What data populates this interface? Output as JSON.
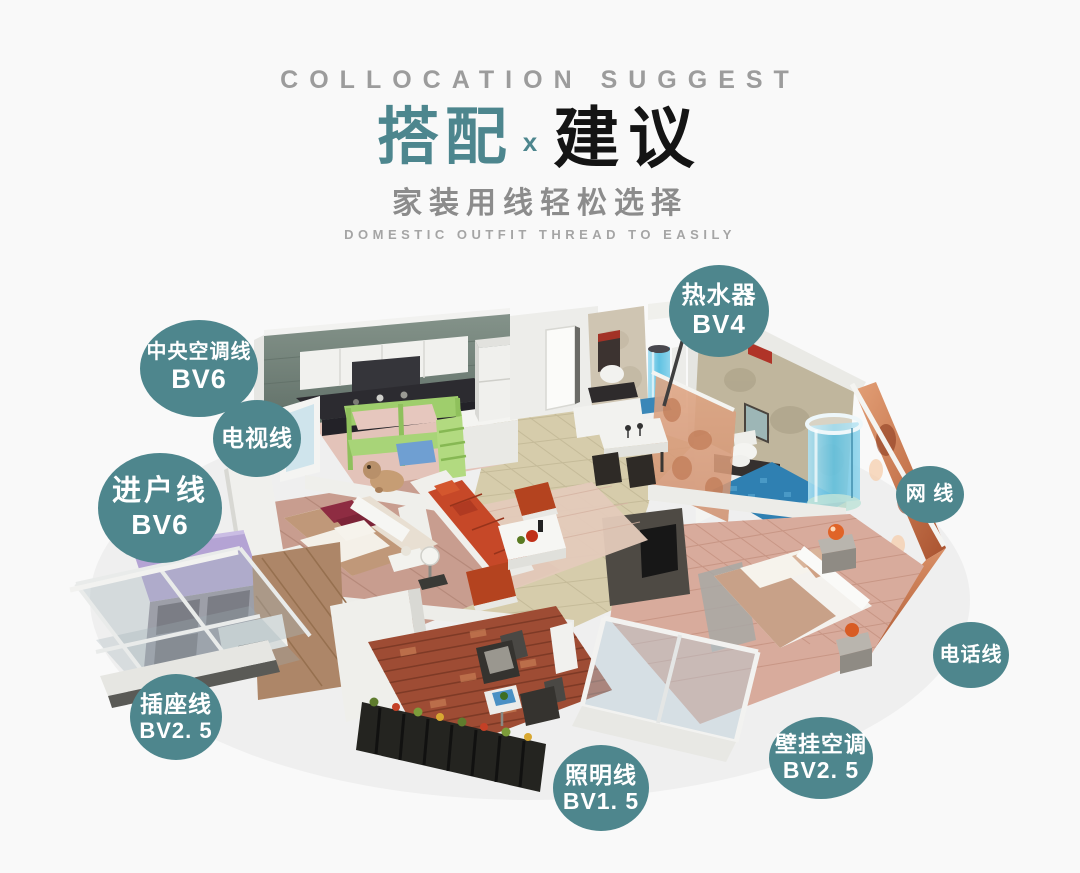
{
  "header": {
    "eyebrow": "COLLOCATION SUGGEST",
    "title_left": "搭配",
    "title_x": "x",
    "title_right": "建议",
    "subtitle": "家装用线轻松选择",
    "subtitle_en": "DOMESTIC OUTFIT THREAD TO EASILY"
  },
  "badges": [
    {
      "id": "water-heater",
      "line1": "热水器",
      "line2": "BV4"
    },
    {
      "id": "central-ac",
      "line1": "中央空调线",
      "line2": "BV6"
    },
    {
      "id": "tv-line",
      "line1": "电视线",
      "line2": null
    },
    {
      "id": "entry-line",
      "line1": "进户线",
      "line2": "BV6"
    },
    {
      "id": "network-line",
      "line1": "网 线",
      "line2": null
    },
    {
      "id": "phone-line",
      "line1": "电话线",
      "line2": null
    },
    {
      "id": "socket-line",
      "line1": "插座线",
      "line2": "BV2. 5"
    },
    {
      "id": "lighting-line",
      "line1": "照明线",
      "line2": "BV1. 5"
    },
    {
      "id": "wall-ac",
      "line1": "壁挂空调",
      "line2": "BV2. 5"
    }
  ],
  "colors": {
    "badge-teal": "#4e868d",
    "title-teal": "#4d868e",
    "title-dark": "#141414",
    "eyebrow-gray": "#9c9c9c",
    "subtitle-gray": "#8c8c8c",
    "subtitle-en-gray": "#a5a5a5",
    "background": "#f9f9f9"
  }
}
